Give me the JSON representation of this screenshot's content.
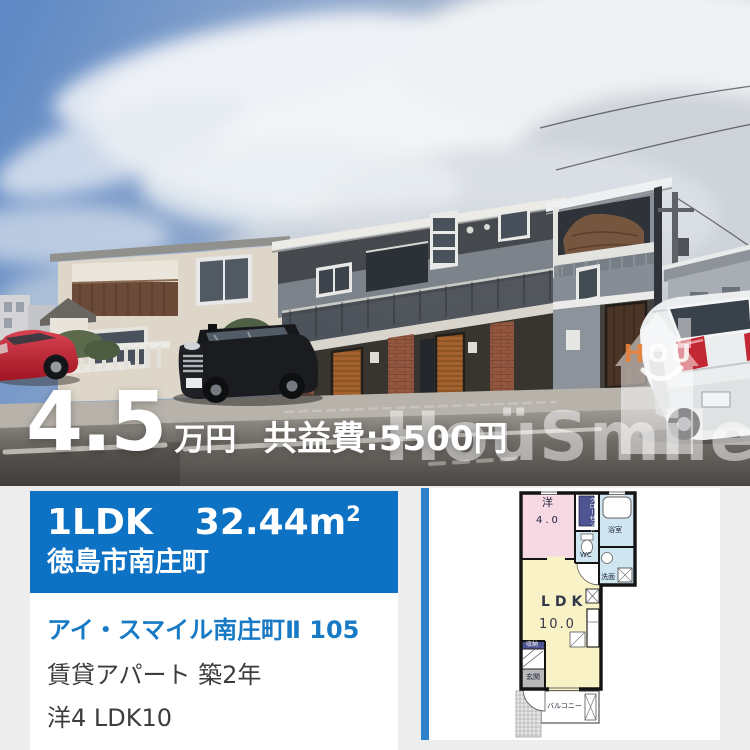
{
  "photo_overlay": {
    "price_value": "4.5",
    "price_unit": "万円",
    "fee": "共益費:5500円",
    "watermark": {
      "brand_text": "HoüSmile",
      "logo_h": "H",
      "logo_o": "O",
      "logo_u": "U"
    }
  },
  "summary": {
    "layout": "1LDK",
    "area_value": "32.44",
    "area_unit": "m",
    "area_exponent": "2",
    "location": "徳島市南庄町"
  },
  "details": {
    "property_name": "アイ・スマイル南庄町Ⅱ 105",
    "building_info": "賃貸アパート 築2年",
    "room_info": "洋4 LDK10"
  },
  "floorplan": {
    "western_room_label": "洋",
    "western_room_size": "4.0",
    "ldk_label": "LDK",
    "ldk_size": "10.0",
    "bath_label": "浴室",
    "toilet_label": "WC",
    "washroom_label": "洗面",
    "entrance_label": "玄関",
    "balcony_label": "バルコニー",
    "storage_label": "収納",
    "closet_right_col": "クロー",
    "closet_left_col": "ゼット"
  },
  "colors": {
    "header_blue": "#0d72c4",
    "accent_bar_blue": "#2e82ca",
    "link_blue": "#187ac5",
    "page_bg": "#ededed",
    "plan_pink": "#f7d9e3",
    "plan_yellow": "#f8f2c6",
    "plan_blue": "#cfe6f1",
    "plan_purple": "#4e5391"
  }
}
